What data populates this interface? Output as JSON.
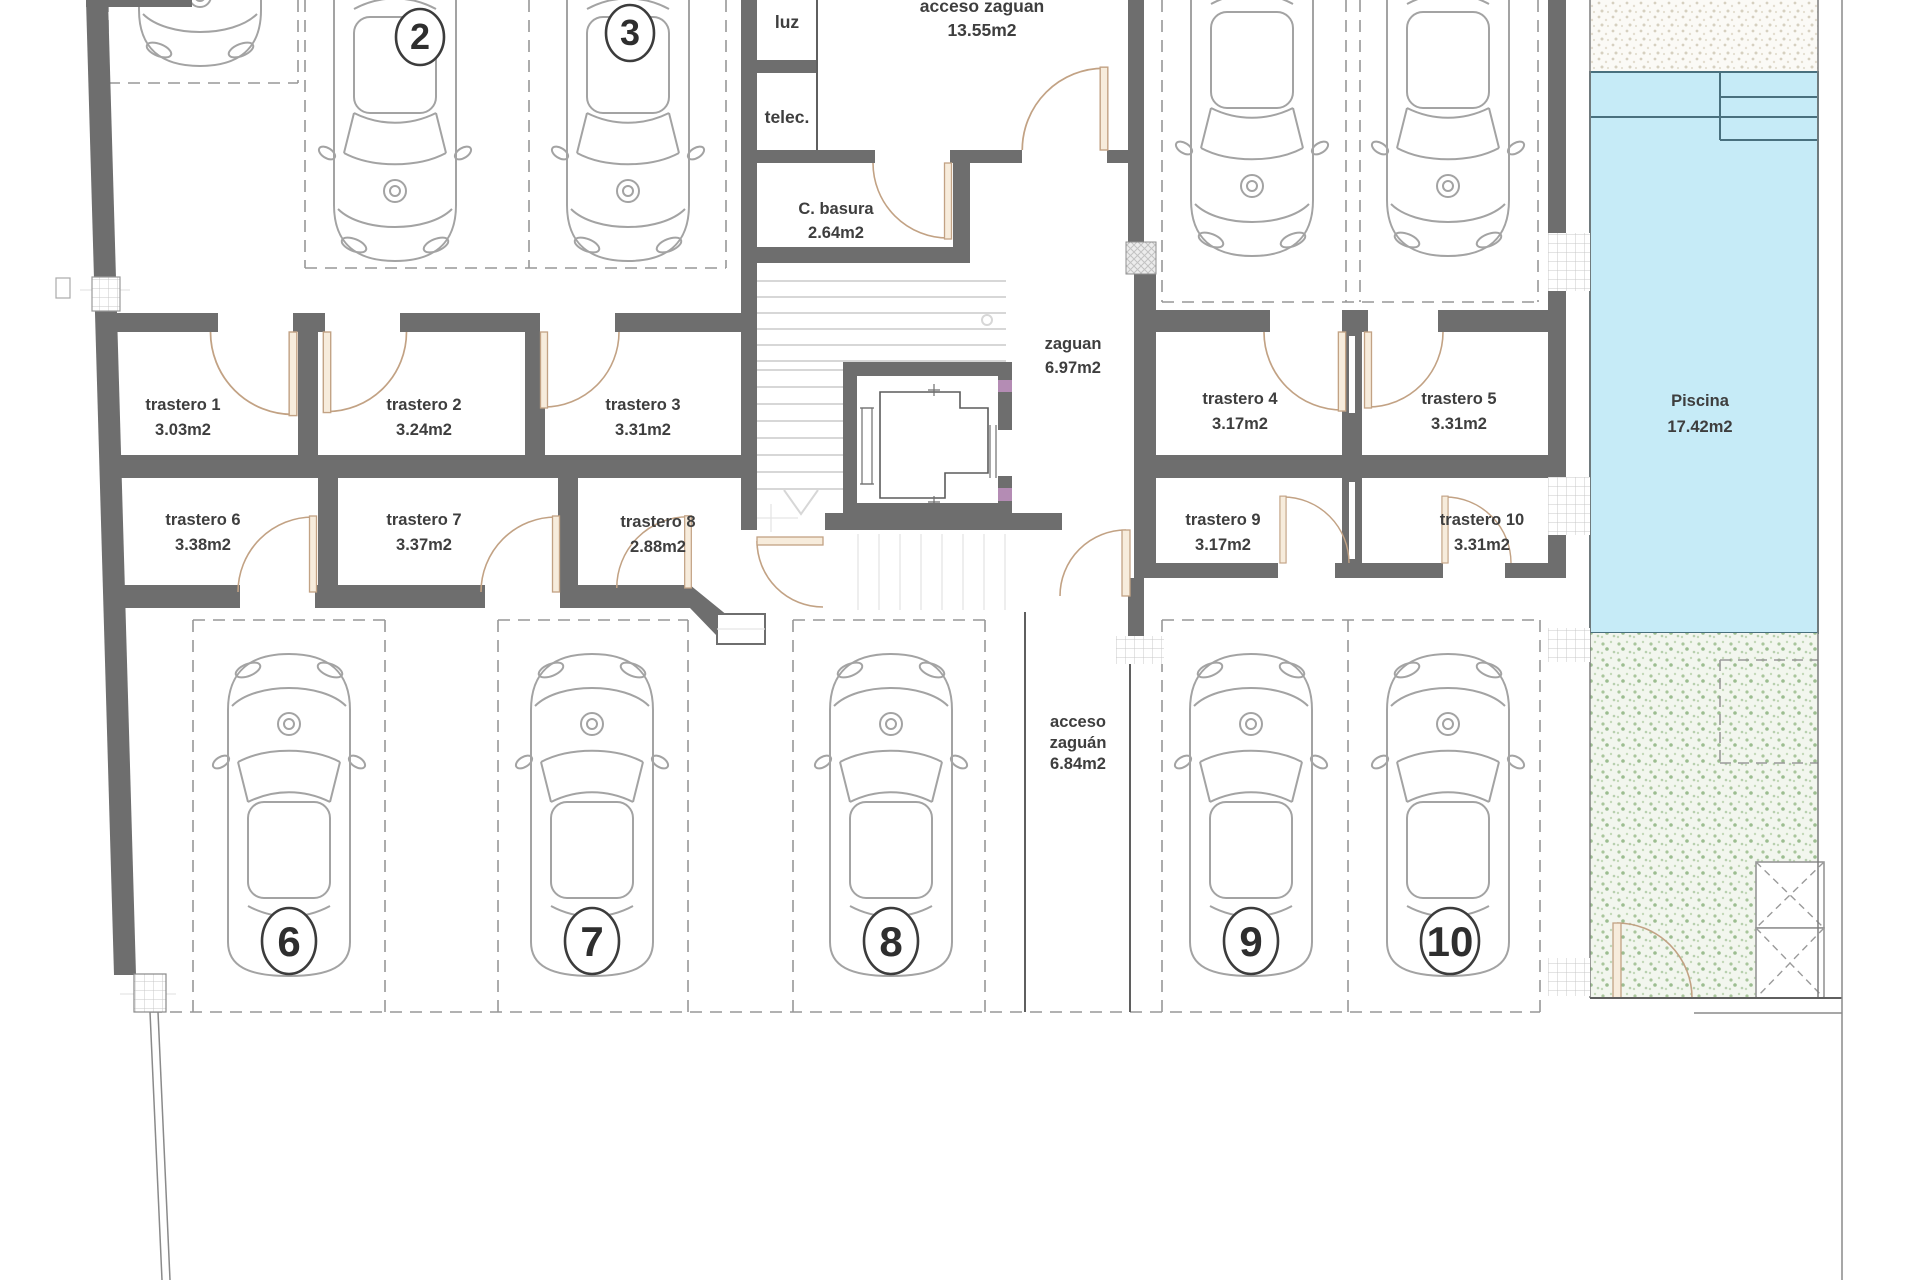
{
  "plan": {
    "labels": {
      "luz": "luz",
      "telec": "telec.",
      "c_basura": "C. basura",
      "c_basura_area": "2.64m2",
      "acceso_top": "acceso zaguan",
      "acceso_top_area": "13.55m2",
      "zaguan": "zaguan",
      "zaguan_area": "6.97m2",
      "acceso_bottom_1": "acceso",
      "acceso_bottom_2": "zaguán",
      "acceso_bottom_area": "6.84m2",
      "piscina": "Piscina",
      "piscina_area": "17.42m2"
    },
    "storage": [
      {
        "name": "trastero 1",
        "area": "3.03m2"
      },
      {
        "name": "trastero 2",
        "area": "3.24m2"
      },
      {
        "name": "trastero 3",
        "area": "3.31m2"
      },
      {
        "name": "trastero 4",
        "area": "3.17m2"
      },
      {
        "name": "trastero 5",
        "area": "3.31m2"
      },
      {
        "name": "trastero 6",
        "area": "3.38m2"
      },
      {
        "name": "trastero 7",
        "area": "3.37m2"
      },
      {
        "name": "trastero 8",
        "area": "2.88m2"
      },
      {
        "name": "trastero 9",
        "area": "3.17m2"
      },
      {
        "name": "trastero 10",
        "area": "3.31m2"
      }
    ],
    "parking": {
      "numbers": [
        "2",
        "3",
        "6",
        "7",
        "8",
        "9",
        "10"
      ]
    }
  },
  "colors": {
    "wall": "#6e6e6e",
    "pool_fill": "#c6ebf7",
    "pool_line": "#49707e",
    "door": "#c2a284",
    "text": "#3e3e3e",
    "lift_accent": "#b48cb4"
  }
}
